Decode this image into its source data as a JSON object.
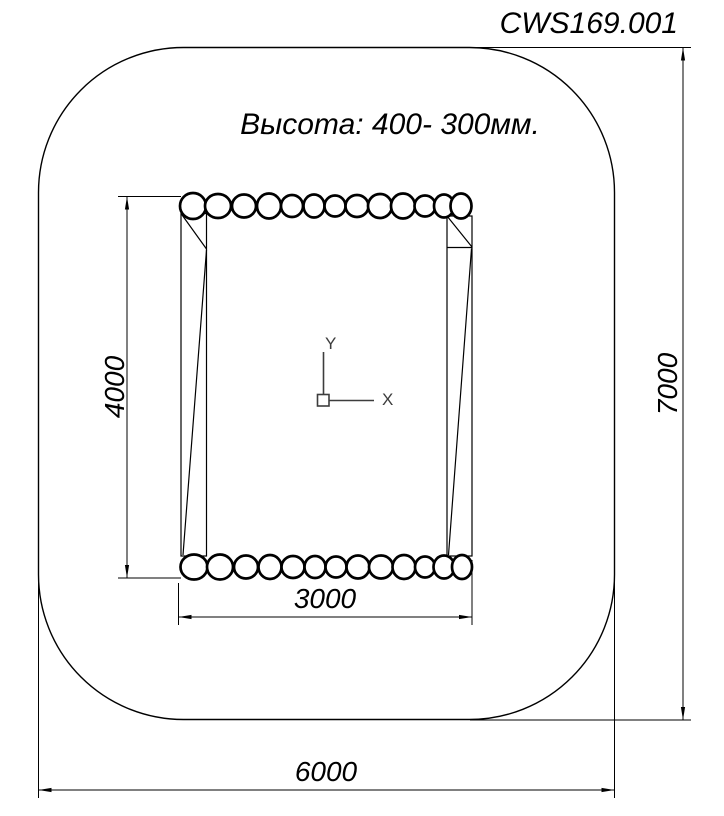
{
  "title": "CWS169.001",
  "note": "Высота: 400- 300мм.",
  "dimensions": {
    "inner_height": "4000",
    "inner_width": "3000",
    "outer_width": "6000",
    "outer_height": "7000"
  },
  "ucs": {
    "x_label": "X",
    "y_label": "Y"
  },
  "colors": {
    "line": "#000000",
    "ucs_icon": "#3d3d3d",
    "background": "#ffffff"
  }
}
